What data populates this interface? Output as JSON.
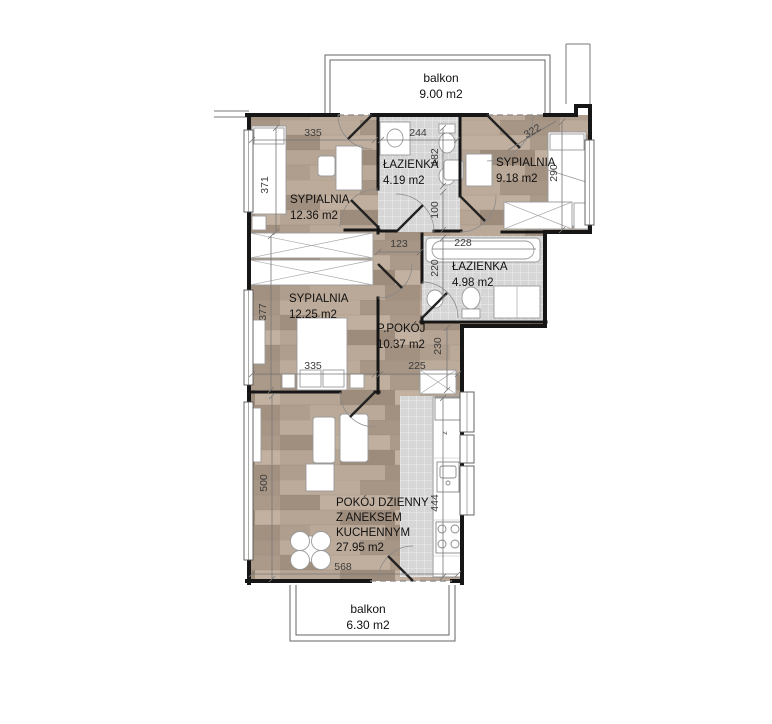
{
  "floorplan": {
    "balconies": [
      {
        "name": "balkon",
        "area": "9.00 m2"
      },
      {
        "name": "balkon",
        "area": "6.30 m2"
      }
    ],
    "rooms": [
      {
        "name": "SYPIALNIA",
        "area": "12.36 m2"
      },
      {
        "name": "ŁAZIENKA",
        "area": "4.19 m2"
      },
      {
        "name": "SYPIALNIA",
        "area": "9.18 m2"
      },
      {
        "name": "ŁAZIENKA",
        "area": "4.98 m2"
      },
      {
        "name": "SYPIALNIA",
        "area": "12.25 m2"
      },
      {
        "name": "P.POKÓJ",
        "area": "10.37 m2"
      },
      {
        "name_line1": "POKÓJ DZIENNY",
        "name_line2": "Z ANEKSEM",
        "name_line3": "KUCHENNYM",
        "area": "27.95 m2"
      }
    ],
    "dimensions": [
      {
        "value": "335"
      },
      {
        "value": "244"
      },
      {
        "value": "322"
      },
      {
        "value": "371"
      },
      {
        "value": "182"
      },
      {
        "value": "290"
      },
      {
        "value": "100"
      },
      {
        "value": "123"
      },
      {
        "value": "228"
      },
      {
        "value": "220"
      },
      {
        "value": "377"
      },
      {
        "value": "335"
      },
      {
        "value": "225"
      },
      {
        "value": "230"
      },
      {
        "value": "500"
      },
      {
        "value": "444"
      },
      {
        "value": "568"
      }
    ],
    "kitchen_marker": "z",
    "colors": {
      "wood": "#b2a090",
      "tile": "#d6d6d6",
      "wall": "#161616",
      "dimension_text": "#3c3c3c"
    }
  }
}
